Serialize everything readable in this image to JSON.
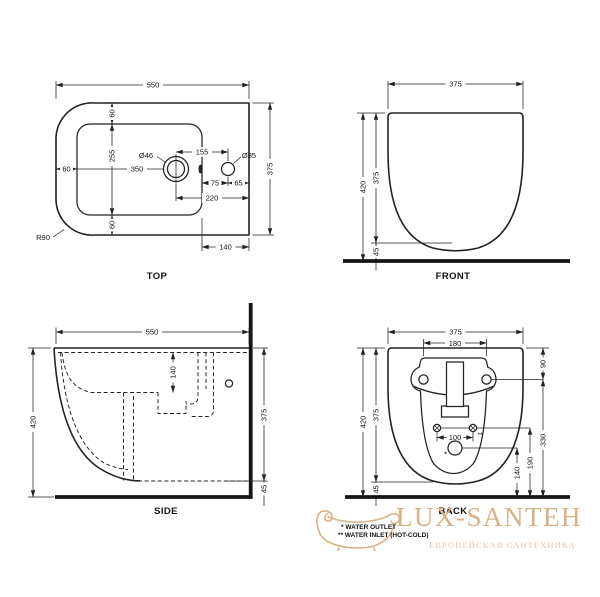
{
  "views": {
    "top": {
      "label": "TOP",
      "dims": {
        "overall_width": "550",
        "overall_depth": "375",
        "rim_top": "60",
        "inner_depth": "255",
        "rim_bottom": "60",
        "rim_left": "60",
        "faucet_center": "350",
        "faucet_hole": "Ø46",
        "hole_spacing": "155",
        "side_hole": "Ø35",
        "side_hole_offset": "75",
        "side_hole_edge": "65",
        "faucet_edge": "220",
        "ledge_width": "140",
        "corner_radius": "R90"
      }
    },
    "front": {
      "label": "FRONT",
      "dims": {
        "width": "375",
        "total_height": "420",
        "body_height": "375",
        "floor_gap": "45"
      }
    },
    "side": {
      "label": "SIDE",
      "dims": {
        "depth": "550",
        "total_height": "420",
        "basin_depth": "140",
        "body_height": "375",
        "floor_gap": "45"
      }
    },
    "back": {
      "label": "BACK",
      "dims": {
        "width": "375",
        "mount_spacing": "180",
        "top_to_mount": "90",
        "mount_to_floor": "330",
        "inlet_spacing": "100",
        "inlet_height": "190",
        "outlet_height": "140",
        "total_height": "420",
        "body_height": "375",
        "floor_gap": "45",
        "outlet_mark": "*",
        "inlet_mark": "**"
      }
    }
  },
  "legend": {
    "outlet_note": "* WATER OUTLET",
    "inlet_note": "** WATER INLET (HOT-COLD)"
  },
  "watermark": {
    "brand": "LUX-SANTEH",
    "tagline": "ЕВРОПЕЙСКАЯ САНТЕХНИКА",
    "brand_color": "#d8b284",
    "tagline_color": "#e6c4a4"
  },
  "colors": {
    "line": "#222222",
    "background": "#ffffff"
  }
}
